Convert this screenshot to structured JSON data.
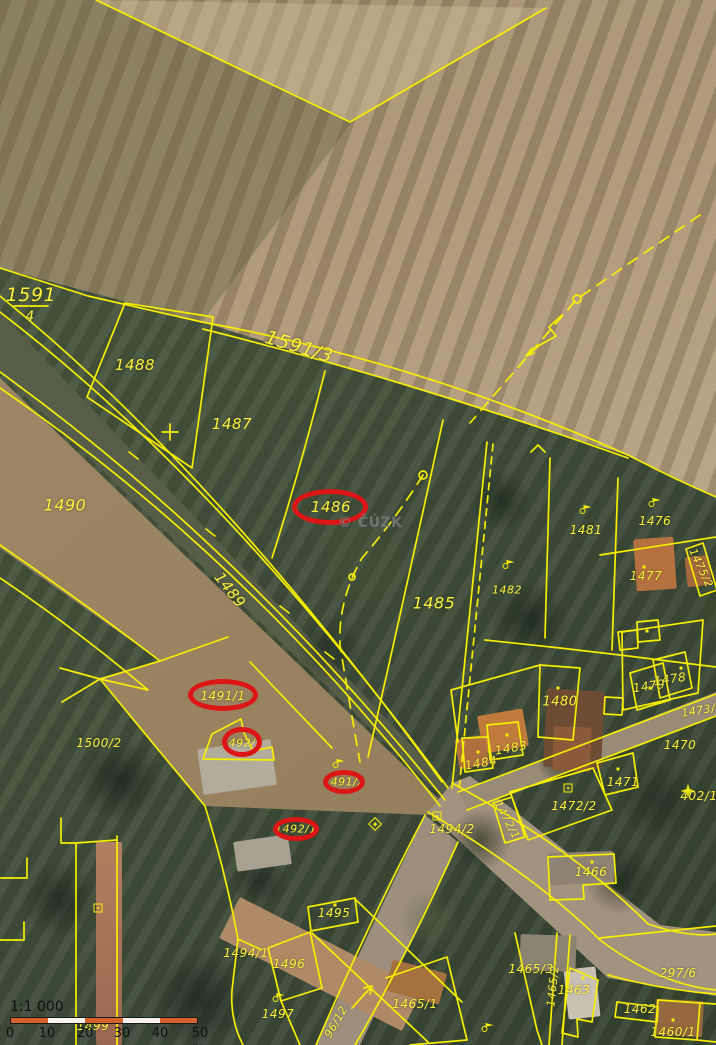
{
  "map": {
    "watermark_text": "© ČÚZK",
    "colors": {
      "parcel_line": "#f6ee00",
      "parcel_label": "#fcf23c",
      "highlight": "#dd1515",
      "scalebar_orange": "#d2622a",
      "scalebar_white": "#f7f3ec"
    },
    "parcel_labels": [
      {
        "t": "1591",
        "x": 31,
        "y": 295,
        "s": 19
      },
      {
        "t": "4",
        "x": 30,
        "y": 317,
        "s": 14
      },
      {
        "t": "1488",
        "x": 135,
        "y": 365,
        "s": 15
      },
      {
        "t": "1591/3",
        "x": 299,
        "y": 347,
        "s": 19,
        "r": 17
      },
      {
        "t": "1487",
        "x": 232,
        "y": 424,
        "s": 15
      },
      {
        "t": "1486",
        "x": 331,
        "y": 507,
        "s": 15
      },
      {
        "t": "1490",
        "x": 65,
        "y": 505,
        "s": 16
      },
      {
        "t": "1489",
        "x": 230,
        "y": 590,
        "s": 15,
        "r": 52
      },
      {
        "t": "1485",
        "x": 434,
        "y": 603,
        "s": 16
      },
      {
        "t": "1482",
        "x": 507,
        "y": 590,
        "s": 11
      },
      {
        "t": "1481",
        "x": 586,
        "y": 530,
        "s": 12
      },
      {
        "t": "1476",
        "x": 655,
        "y": 521,
        "s": 12
      },
      {
        "t": "1477",
        "x": 646,
        "y": 576,
        "s": 12
      },
      {
        "t": "1479",
        "x": 649,
        "y": 686,
        "s": 12,
        "r": -8
      },
      {
        "t": "1478",
        "x": 670,
        "y": 679,
        "s": 12,
        "r": -8
      },
      {
        "t": "1475/2",
        "x": 701,
        "y": 568,
        "s": 11,
        "r": 65
      },
      {
        "t": "1480",
        "x": 560,
        "y": 702,
        "s": 13
      },
      {
        "t": "1483",
        "x": 511,
        "y": 748,
        "s": 12,
        "r": -10
      },
      {
        "t": "1484",
        "x": 481,
        "y": 763,
        "s": 12,
        "r": -10
      },
      {
        "t": "1473/2",
        "x": 702,
        "y": 710,
        "s": 11,
        "r": -9
      },
      {
        "t": "1470",
        "x": 680,
        "y": 745,
        "s": 12
      },
      {
        "t": "1471",
        "x": 623,
        "y": 782,
        "s": 12
      },
      {
        "t": "1472/2",
        "x": 574,
        "y": 806,
        "s": 12
      },
      {
        "t": "1472/1",
        "x": 507,
        "y": 820,
        "s": 11,
        "r": 62
      },
      {
        "t": "402/10",
        "x": 703,
        "y": 796,
        "s": 12
      },
      {
        "t": "1500/2",
        "x": 99,
        "y": 743,
        "s": 12
      },
      {
        "t": "1491/1",
        "x": 223,
        "y": 696,
        "s": 12
      },
      {
        "t": "1492/2",
        "x": 242,
        "y": 743,
        "s": 11
      },
      {
        "t": "1491/2",
        "x": 344,
        "y": 782,
        "s": 11
      },
      {
        "t": "1492/1",
        "x": 296,
        "y": 829,
        "s": 11
      },
      {
        "t": "1494/2",
        "x": 452,
        "y": 829,
        "s": 12
      },
      {
        "t": "1466",
        "x": 591,
        "y": 872,
        "s": 12
      },
      {
        "t": "1495",
        "x": 334,
        "y": 913,
        "s": 12
      },
      {
        "t": "1494/1",
        "x": 246,
        "y": 953,
        "s": 12
      },
      {
        "t": "1496",
        "x": 289,
        "y": 964,
        "s": 12
      },
      {
        "t": "1497",
        "x": 278,
        "y": 1014,
        "s": 12
      },
      {
        "t": "96/12",
        "x": 336,
        "y": 1022,
        "s": 11,
        "r": -60
      },
      {
        "t": "1465/1",
        "x": 415,
        "y": 1004,
        "s": 12
      },
      {
        "t": "1465/3",
        "x": 531,
        "y": 969,
        "s": 12
      },
      {
        "t": "1465/2",
        "x": 553,
        "y": 986,
        "s": 11,
        "r": -84
      },
      {
        "t": "1463",
        "x": 574,
        "y": 990,
        "s": 12
      },
      {
        "t": "1462",
        "x": 640,
        "y": 1009,
        "s": 12
      },
      {
        "t": "297/6",
        "x": 678,
        "y": 973,
        "s": 12
      },
      {
        "t": "1460/1",
        "x": 673,
        "y": 1032,
        "s": 12
      },
      {
        "t": "1499",
        "x": 93,
        "y": 1026,
        "s": 12
      }
    ],
    "highlights": [
      {
        "x": 330,
        "y": 507,
        "rx": 38,
        "ry": 18
      },
      {
        "x": 223,
        "y": 695,
        "rx": 35,
        "ry": 16
      },
      {
        "x": 242,
        "y": 742,
        "rx": 20,
        "ry": 15
      },
      {
        "x": 344,
        "y": 782,
        "rx": 21,
        "ry": 12
      },
      {
        "x": 296,
        "y": 829,
        "rx": 23,
        "ry": 12
      }
    ],
    "symbols": [
      {
        "type": "flag",
        "x": 586,
        "y": 509
      },
      {
        "type": "flag",
        "x": 655,
        "y": 502
      },
      {
        "type": "flag",
        "x": 509,
        "y": 564
      },
      {
        "type": "flag",
        "x": 279,
        "y": 997
      },
      {
        "type": "flag",
        "x": 488,
        "y": 1027
      },
      {
        "type": "flag",
        "x": 339,
        "y": 763
      },
      {
        "type": "dot",
        "x": 558,
        "y": 688
      },
      {
        "type": "dot",
        "x": 507,
        "y": 735
      },
      {
        "type": "dot",
        "x": 478,
        "y": 752
      },
      {
        "type": "dot",
        "x": 644,
        "y": 567
      },
      {
        "type": "dot",
        "x": 592,
        "y": 862
      },
      {
        "type": "dot",
        "x": 583,
        "y": 978
      },
      {
        "type": "dot",
        "x": 673,
        "y": 1020
      },
      {
        "type": "dot",
        "x": 618,
        "y": 769
      },
      {
        "type": "dot",
        "x": 647,
        "y": 631
      },
      {
        "type": "dot",
        "x": 335,
        "y": 905
      },
      {
        "type": "dot",
        "x": 650,
        "y": 688
      },
      {
        "type": "dot",
        "x": 681,
        "y": 668
      },
      {
        "type": "square",
        "x": 568,
        "y": 788
      },
      {
        "type": "square",
        "x": 98,
        "y": 908
      },
      {
        "type": "square",
        "x": 437,
        "y": 816
      },
      {
        "type": "diamond",
        "x": 375,
        "y": 824
      },
      {
        "type": "star",
        "x": 688,
        "y": 793
      }
    ]
  },
  "scalebar": {
    "scale_text": "1:1 000",
    "ticks": [
      "0",
      "10",
      "20",
      "30",
      "40",
      "50 m"
    ],
    "tick_x": [
      0,
      37,
      75,
      112,
      150,
      190
    ]
  }
}
